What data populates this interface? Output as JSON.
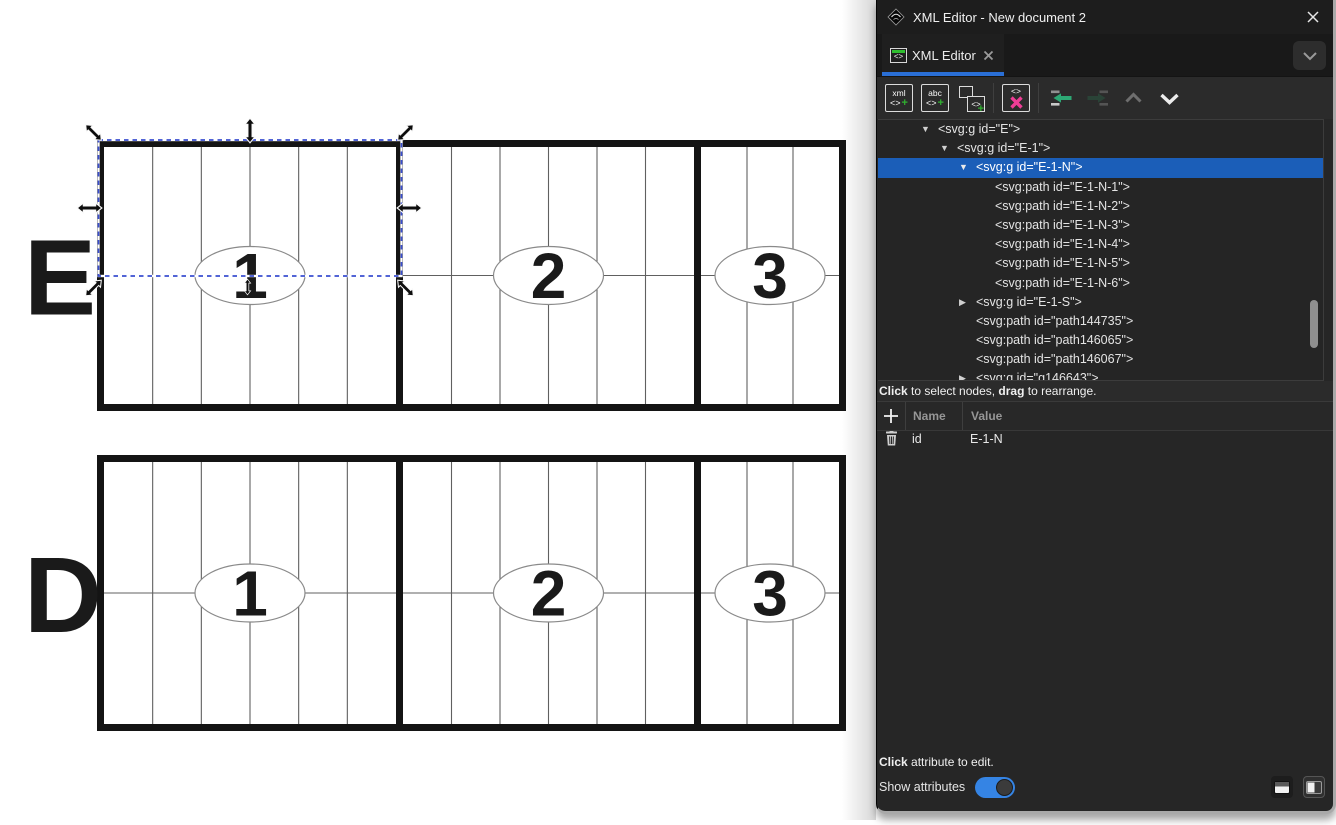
{
  "window": {
    "title": "XML Editor - New document 2"
  },
  "tab": {
    "icon": "<>",
    "label": "XML Editor"
  },
  "toolbar": {
    "buttons": [
      {
        "name": "new-element-node",
        "glyphs": [
          "xml",
          "<>",
          "+"
        ]
      },
      {
        "name": "new-text-node",
        "glyphs": [
          "abc",
          "<>",
          "+"
        ]
      },
      {
        "name": "duplicate-node",
        "glyphs": [
          "<>",
          "+"
        ]
      },
      {
        "name": "delete-node",
        "glyphs": [
          "<>"
        ]
      },
      {
        "name": "unindent-node",
        "glyphs": []
      },
      {
        "name": "indent-node",
        "glyphs": []
      },
      {
        "name": "move-node-up",
        "glyphs": []
      },
      {
        "name": "move-node-down",
        "glyphs": []
      }
    ]
  },
  "tree": {
    "rows": [
      {
        "indent": 1,
        "state": "expanded",
        "selected": false,
        "text": "<svg:g id=\"E\">"
      },
      {
        "indent": 2,
        "state": "expanded",
        "selected": false,
        "text": "<svg:g id=\"E-1\">"
      },
      {
        "indent": 3,
        "state": "expanded",
        "selected": true,
        "text": "<svg:g id=\"E-1-N\">"
      },
      {
        "indent": 4,
        "state": null,
        "selected": false,
        "text": "<svg:path id=\"E-1-N-1\">"
      },
      {
        "indent": 4,
        "state": null,
        "selected": false,
        "text": "<svg:path id=\"E-1-N-2\">"
      },
      {
        "indent": 4,
        "state": null,
        "selected": false,
        "text": "<svg:path id=\"E-1-N-3\">"
      },
      {
        "indent": 4,
        "state": null,
        "selected": false,
        "text": "<svg:path id=\"E-1-N-4\">"
      },
      {
        "indent": 4,
        "state": null,
        "selected": false,
        "text": "<svg:path id=\"E-1-N-5\">"
      },
      {
        "indent": 4,
        "state": null,
        "selected": false,
        "text": "<svg:path id=\"E-1-N-6\">"
      },
      {
        "indent": 3,
        "state": "collapsed",
        "selected": false,
        "text": "<svg:g id=\"E-1-S\">"
      },
      {
        "indent": 3,
        "state": null,
        "selected": false,
        "text": "<svg:path id=\"path144735\">"
      },
      {
        "indent": 3,
        "state": null,
        "selected": false,
        "text": "<svg:path id=\"path146065\">"
      },
      {
        "indent": 3,
        "state": null,
        "selected": false,
        "text": "<svg:path id=\"path146067\">"
      },
      {
        "indent": 3,
        "state": "collapsed",
        "selected": false,
        "text": "<svg:g id=\"g146643\">"
      }
    ]
  },
  "status_hint": {
    "bold1": "Click",
    "text1": " to select nodes, ",
    "bold2": "drag",
    "text2": " to rearrange."
  },
  "attributes": {
    "add_label": "+",
    "columns": {
      "name": "Name",
      "value": "Value"
    },
    "rows": [
      {
        "name": "id",
        "value": "E-1-N"
      }
    ],
    "hint": {
      "bold": "Click",
      "rest": " attribute to edit."
    },
    "show_attributes": {
      "label": "Show attributes",
      "on": true
    }
  },
  "canvas": {
    "rows": [
      {
        "letter": "E",
        "sections": [
          "1",
          "2",
          "3"
        ]
      },
      {
        "letter": "D",
        "sections": [
          "1",
          "2",
          "3"
        ]
      }
    ]
  },
  "colors": {
    "tab_underline_blue": "#2a6fd6",
    "tree_selection_blue": "#1b5eb8",
    "toggle_blue": "#3584e4",
    "add_green": "#30b030",
    "delete_pink": "#ee3d96",
    "unindent_teal": "#2da874",
    "selection_dash_blue": "#3a4fd0"
  }
}
